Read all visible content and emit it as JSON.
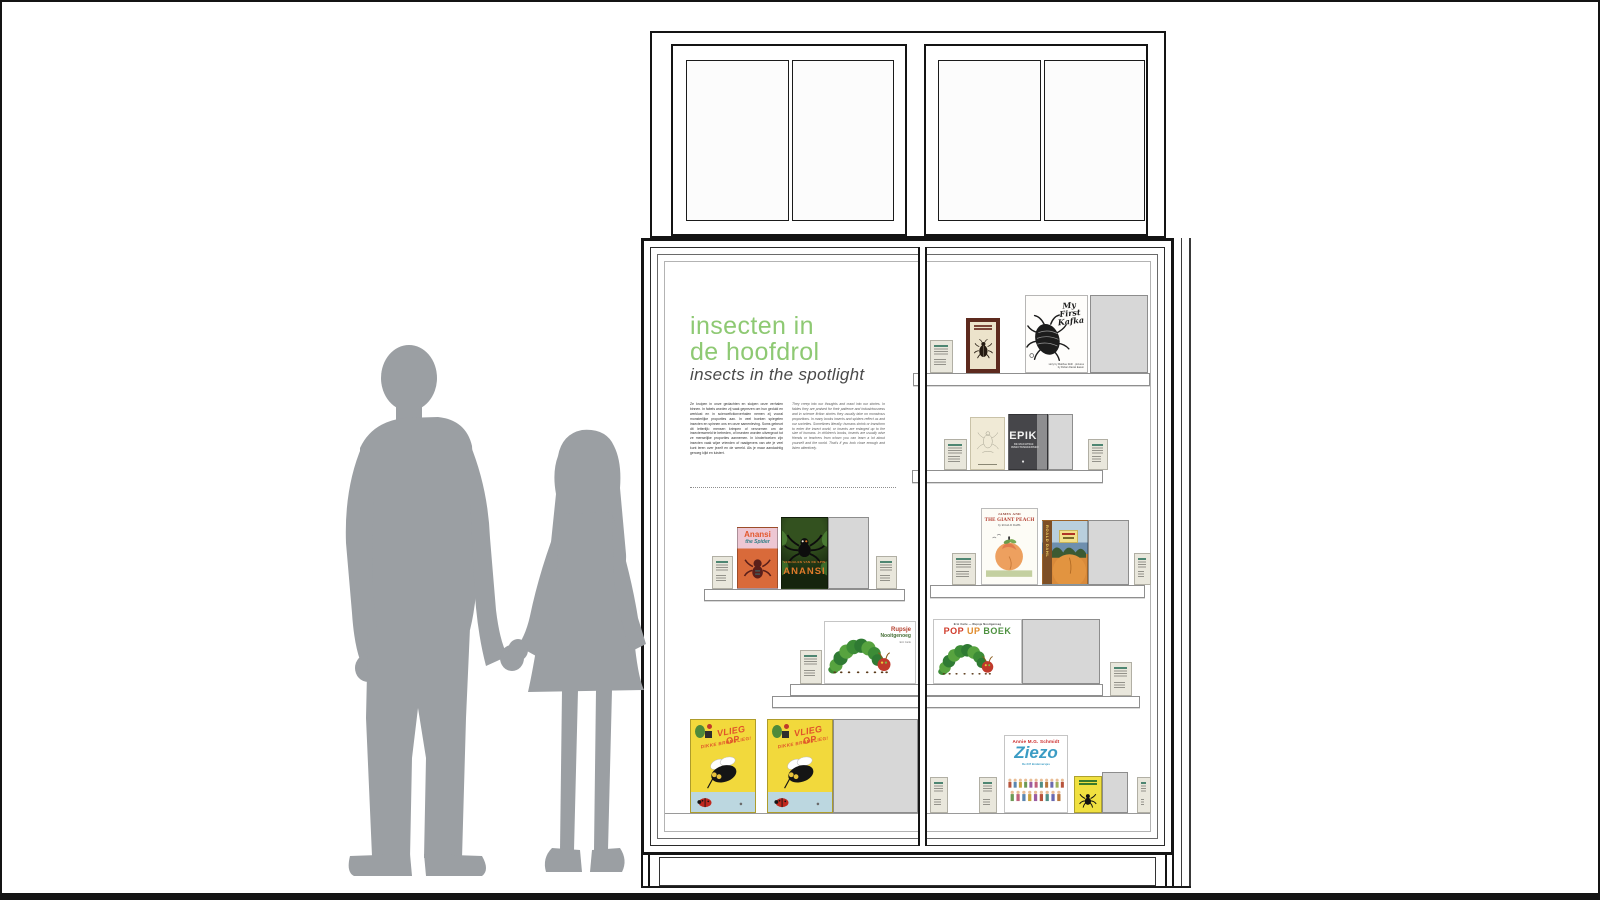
{
  "exhibit": {
    "title_line1": "insecten in",
    "title_line2": "de hoofdrol",
    "subtitle": "insects in the spotlight",
    "intro_dutch": "Ze kruipen in onze gedachten en sluipen onze verhalen binnen. In fabels worden zij vaak geprezen om hun geduld en werklust en in sciencefictionverhalen nemen zij vooral monsterlijke proporties aan. In veel boeken spiegelen insecten en spinnen ons en onze samenleving. Soms gebeurt dit letterlijk: mensen krimpen of vervormen om de insectenwereld te betreden, of insecten worden uitvergroot tot ze menselijke proporties aannemen. In kinderboeken zijn insecten vaak wijze vrienden of raadgevers van wie je veel kunt leren over jezelf en de wereld. Als je maar aandachtig genoeg kijkt en luistert.",
    "intro_english": "They creep into our thoughts and crawl into our stories. In fables they are praised for their patience and industriousness and in science fiction stories they usually take on monstrous proportions. In many books insects and spiders reflect us and our societies. Sometimes literally: humans shrink or transform to enter the insect world, or insects are enlarged up to the size of humans. In children's books, insects are usually wise friends or teachers from whom you can learn a lot about yourself and the world. That's if you look close enough and listen attentively."
  },
  "books": {
    "my_first_kafka": {
      "title": "My First Kafka",
      "credit": "story by Matthue Roth · pictures by Rohan Daniel Eason"
    },
    "epik": {
      "title": "EPIK",
      "subtitle": "DE MACHTIGE INSECTENHEERSER",
      "mark": "♦"
    },
    "anansi_spider": {
      "title_1": "Anansi",
      "title_2": "the Spider"
    },
    "anansi_nl": {
      "kicker": "VERHALEN VAN DE SPIN",
      "title": "ANANSI"
    },
    "giant_peach_en": {
      "title_1": "JAMES AND",
      "title_2": "THE GIANT PEACH",
      "author": "by ROALD DAHL"
    },
    "giant_peach_nl": {
      "spine": "ROALD DAHL"
    },
    "rupsje": {
      "title_1": "Rupsje",
      "title_2": "Nooitgenoeg",
      "credit": "Eric Carle"
    },
    "popup": {
      "kicker": "Eric Carle — Rupsje Nooitgenoeg",
      "title_pop": "POP",
      "title_up": "UP",
      "title_boek": "BOEK"
    },
    "vlieg_op": {
      "title_1": "VLIEG OP",
      "title_2": "DIKKE BROMVLIEG!"
    },
    "ziezo": {
      "author": "Annie M.G. Schmidt",
      "title": "Ziezo",
      "subtitle": "De 347 kinderversjes"
    }
  },
  "colors": {
    "accent_green": "#8ec973",
    "silhouette_gray": "#9b9fa3",
    "placeholder_gray": "#d7d7d7",
    "label_card": "#e9e7dc",
    "line_black": "#141414"
  }
}
